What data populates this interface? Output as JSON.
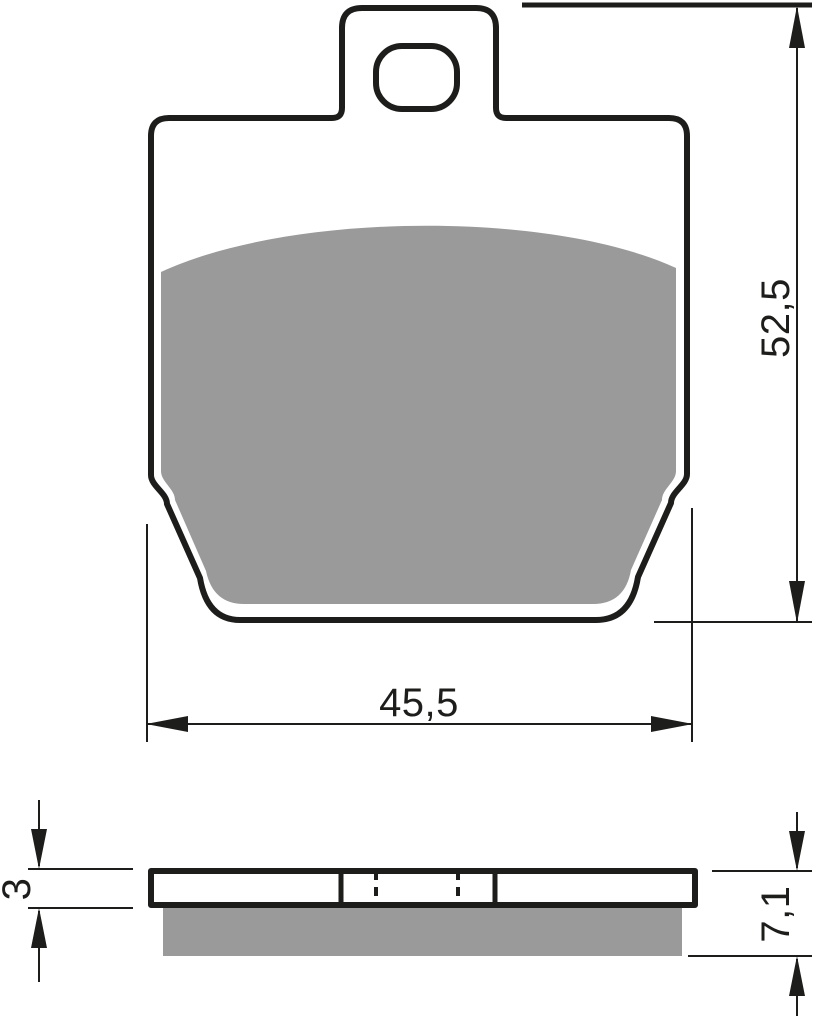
{
  "drawing": {
    "background": "#ffffff",
    "line_color": "#1d1d1b",
    "friction_color": "#9a9a9a",
    "front_view": {
      "height_dimension": "52,5",
      "width_dimension": "45,5"
    },
    "side_view": {
      "plate_thickness_dimension": "3",
      "total_thickness_dimension": "7,1"
    }
  }
}
